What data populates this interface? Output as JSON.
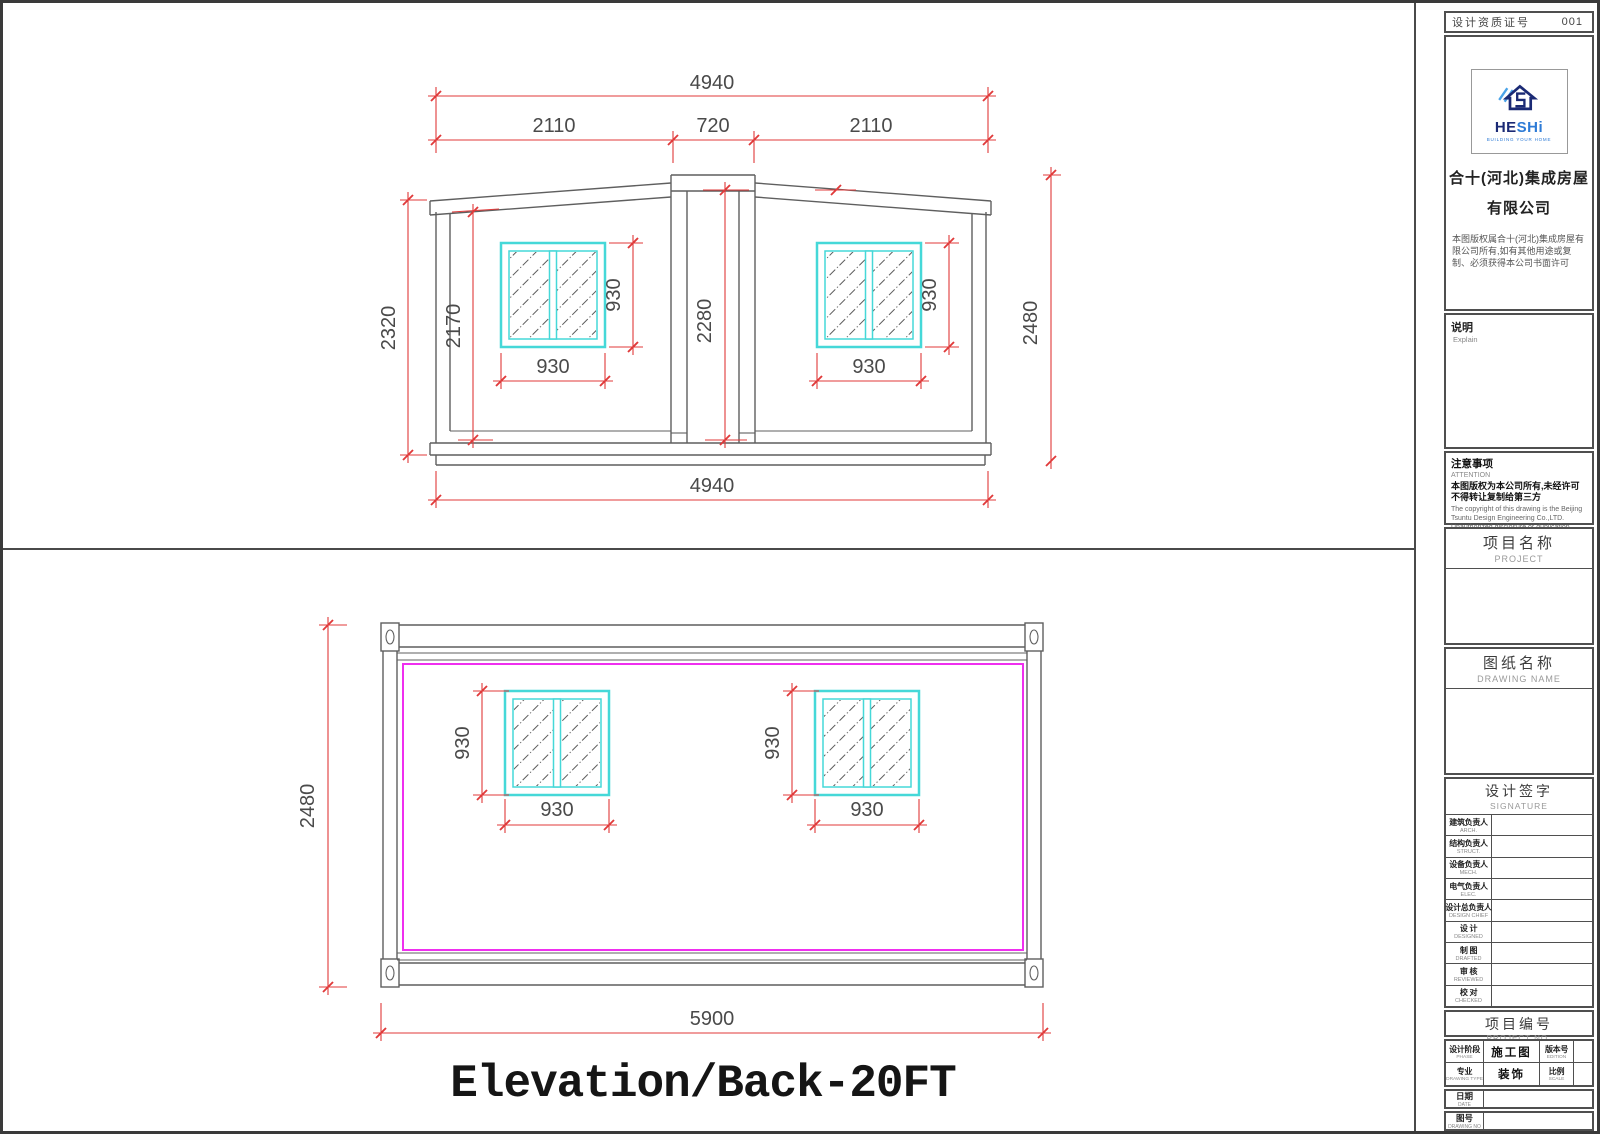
{
  "sheet": {
    "title": "Elevation/Back-20FT"
  },
  "top_elevation": {
    "dim_total_top": "4940",
    "dim_left_bay": "2110",
    "dim_center_bay": "720",
    "dim_right_bay": "2110",
    "dim_left_outer_height": "2320",
    "dim_left_inner_height": "2170",
    "dim_center_height": "2280",
    "dim_right_height": "2480",
    "dim_window_height": "930",
    "dim_window_width": "930",
    "dim_total_bottom": "4940"
  },
  "bottom_elevation": {
    "dim_height": "2480",
    "dim_window_height": "930",
    "dim_window_width": "930",
    "dim_total_width": "5900"
  },
  "title_block": {
    "header": {
      "label": "设计资质证号",
      "number": "001"
    },
    "company": {
      "logo_text_he": "HE",
      "logo_text_shi": "SHi",
      "logo_tagline": "BUILDING YOUR HOME",
      "name_line1": "合十(河北)集成房屋",
      "name_line2": "有限公司",
      "copyright": "本图版权属合十(河北)集成房屋有限公司所有,如有其他用途或复制、必须获得本公司书面许可"
    },
    "explain": {
      "zh": "说明",
      "en": "Explain"
    },
    "attention": {
      "zh": "注意事项",
      "en": "ATTENTION",
      "notice_zh": "本图版权为本公司所有,未经许可不得转让复制给第三方",
      "notice_en": "The copyright of this drawing is the Beijing Tsuntu Design Engineering Co.,LTD. Unauthorized disclosure or duplication party is not permitted"
    },
    "project": {
      "zh": "项目名称",
      "en": "PROJECT"
    },
    "drawing_name": {
      "zh": "图纸名称",
      "en": "DRAWING NAME"
    },
    "signature": {
      "zh": "设计签字",
      "en": "SIGNATURE",
      "rows": [
        {
          "zh": "建筑负责人",
          "en": "ARCH."
        },
        {
          "zh": "结构负责人",
          "en": "STRUCT."
        },
        {
          "zh": "设备负责人",
          "en": "MECH."
        },
        {
          "zh": "电气负责人",
          "en": "ELEC."
        },
        {
          "zh": "设计总负责人",
          "en": "DESIGN CHIEF"
        },
        {
          "zh": "设 计",
          "en": "DESIGNED"
        },
        {
          "zh": "制 图",
          "en": "DRAFTED"
        },
        {
          "zh": "审 核",
          "en": "REVIEWED"
        },
        {
          "zh": "校 对",
          "en": "CHECKED"
        }
      ]
    },
    "project_no": {
      "zh": "项目编号",
      "en": "PROJECT NO."
    },
    "meta": {
      "phase_zh": "设计阶段",
      "phase_en": "PHASE",
      "phase_value": "施工图",
      "edition_zh": "版本号",
      "edition_en": "EDITION",
      "edition_value": "",
      "type_zh": "专业",
      "type_en": "DRAWING TYPE",
      "type_value": "装饰",
      "scale_zh": "比例",
      "scale_en": "SCALE",
      "scale_value": "",
      "date_zh": "日期",
      "date_en": "DATE",
      "date_value": "",
      "no_zh": "图号",
      "no_en": "DRAWING NO",
      "no_value": ""
    }
  },
  "colors": {
    "dimension_red": "#e03a3a",
    "window_cyan": "#45d8d8",
    "panel_magenta": "#ef2fef",
    "line_gray": "#5f5f5f",
    "logo_navy": "#1b2a75",
    "logo_blue": "#2e7bd6"
  }
}
